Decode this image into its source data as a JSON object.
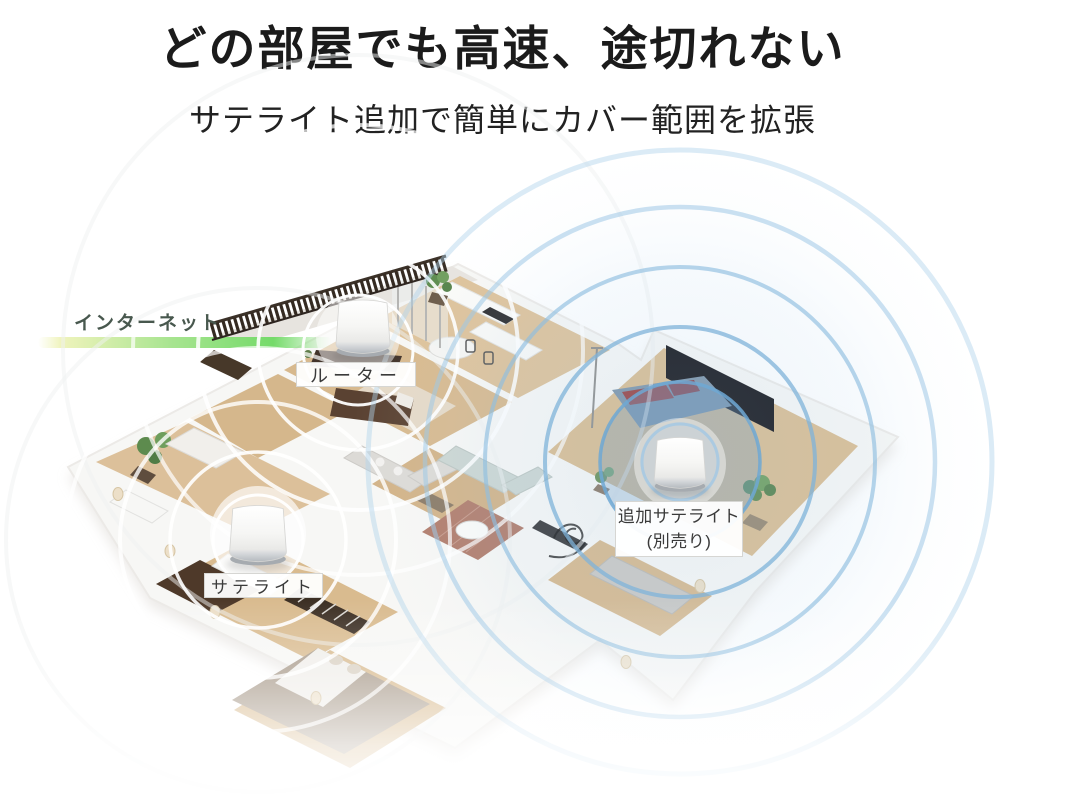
{
  "page": {
    "background": "#ffffff"
  },
  "header": {
    "title": "どの部屋でも高速、途切れない",
    "subtitle": "サテライト追加で簡単にカバー範囲を拡張",
    "title_color": "#1b1b1b"
  },
  "diagram": {
    "internet": {
      "label": "インターネット",
      "label_color": "#48584e",
      "line_gradient": [
        "#edf2b4",
        "#72da67"
      ]
    },
    "labels": {
      "router": "ルーター",
      "satellite": "サテライト",
      "additional_satellite_line1": "追加サテライト",
      "additional_satellite_line2": "(別売り)"
    },
    "devices": [
      {
        "id": "router",
        "type": "mesh-wifi-router"
      },
      {
        "id": "satellite",
        "type": "mesh-wifi-satellite"
      },
      {
        "id": "additional-satellite",
        "type": "mesh-wifi-satellite-optional"
      }
    ],
    "wifi_colors": {
      "router_rings": "#ffffff",
      "satellite_rings": "#ffffff",
      "additional_satellite_rings": "#7fb3da"
    },
    "house_colors": {
      "floor_wood": "#d9bc92",
      "walls": "#f7f7f5",
      "deck_railing": "#352b22",
      "accent_wall": "#15151a",
      "bed_blue": "#7e95aa",
      "bathroom_brick": "#b17c6b"
    }
  }
}
